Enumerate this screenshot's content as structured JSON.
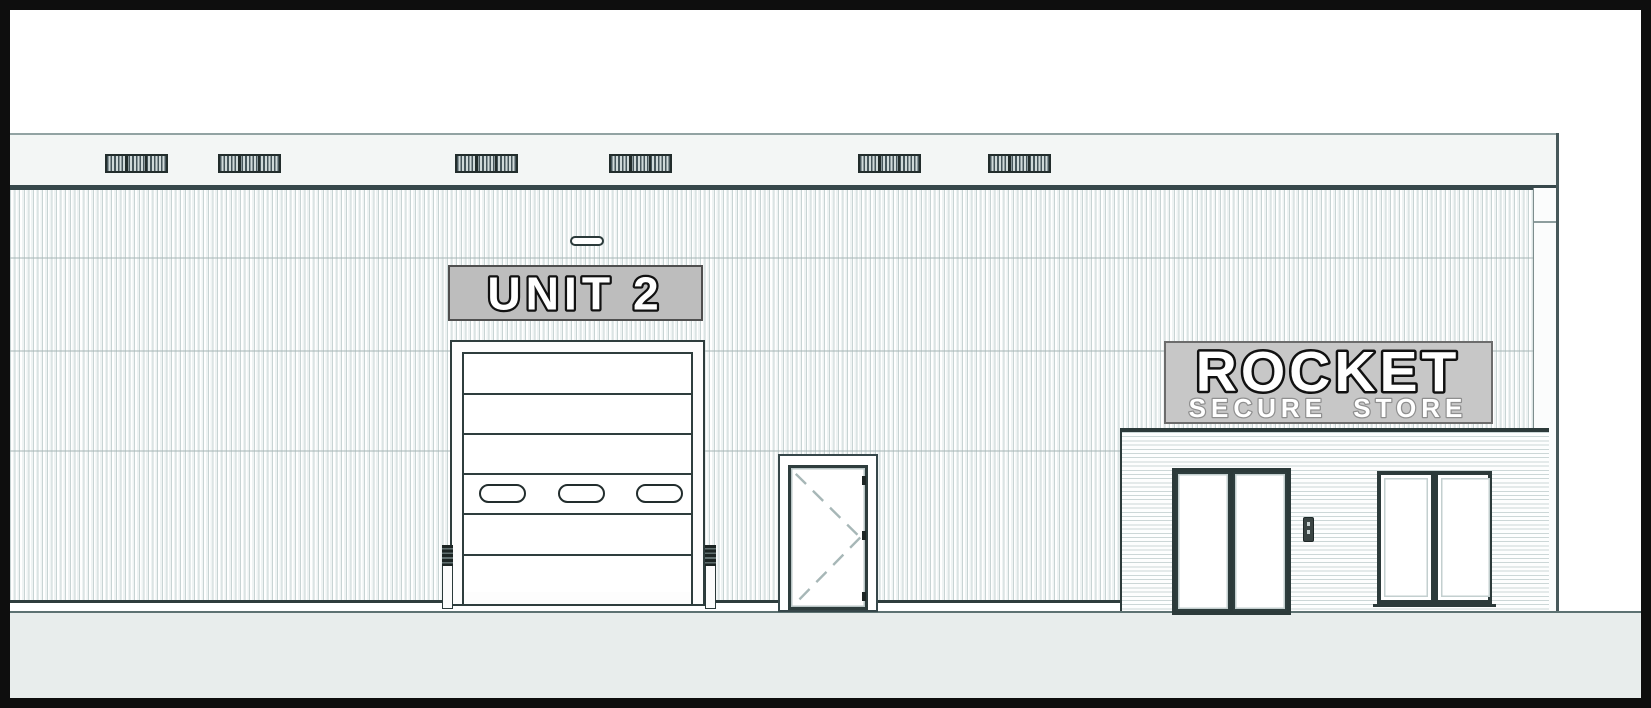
{
  "document": {
    "type": "architectural-elevation-drawing",
    "signs": {
      "unit_label": "UNIT 2",
      "store_name": "ROCKET",
      "store_tagline": "SECURE STORE"
    },
    "colors": {
      "linework": "#2e3d3d",
      "unit_sign_bg": "#bdbdbd",
      "store_sign_bg": "#c7c7c7",
      "cladding_stripe": "#dde6e6",
      "fascia": "#f3f6f5",
      "ground": "#e8edec",
      "page_border": "#0e0e0e"
    },
    "features": {
      "louver_vent_count": 6,
      "roller_door_panel_count": 6,
      "roller_door_vision_panel_count": 3
    }
  }
}
